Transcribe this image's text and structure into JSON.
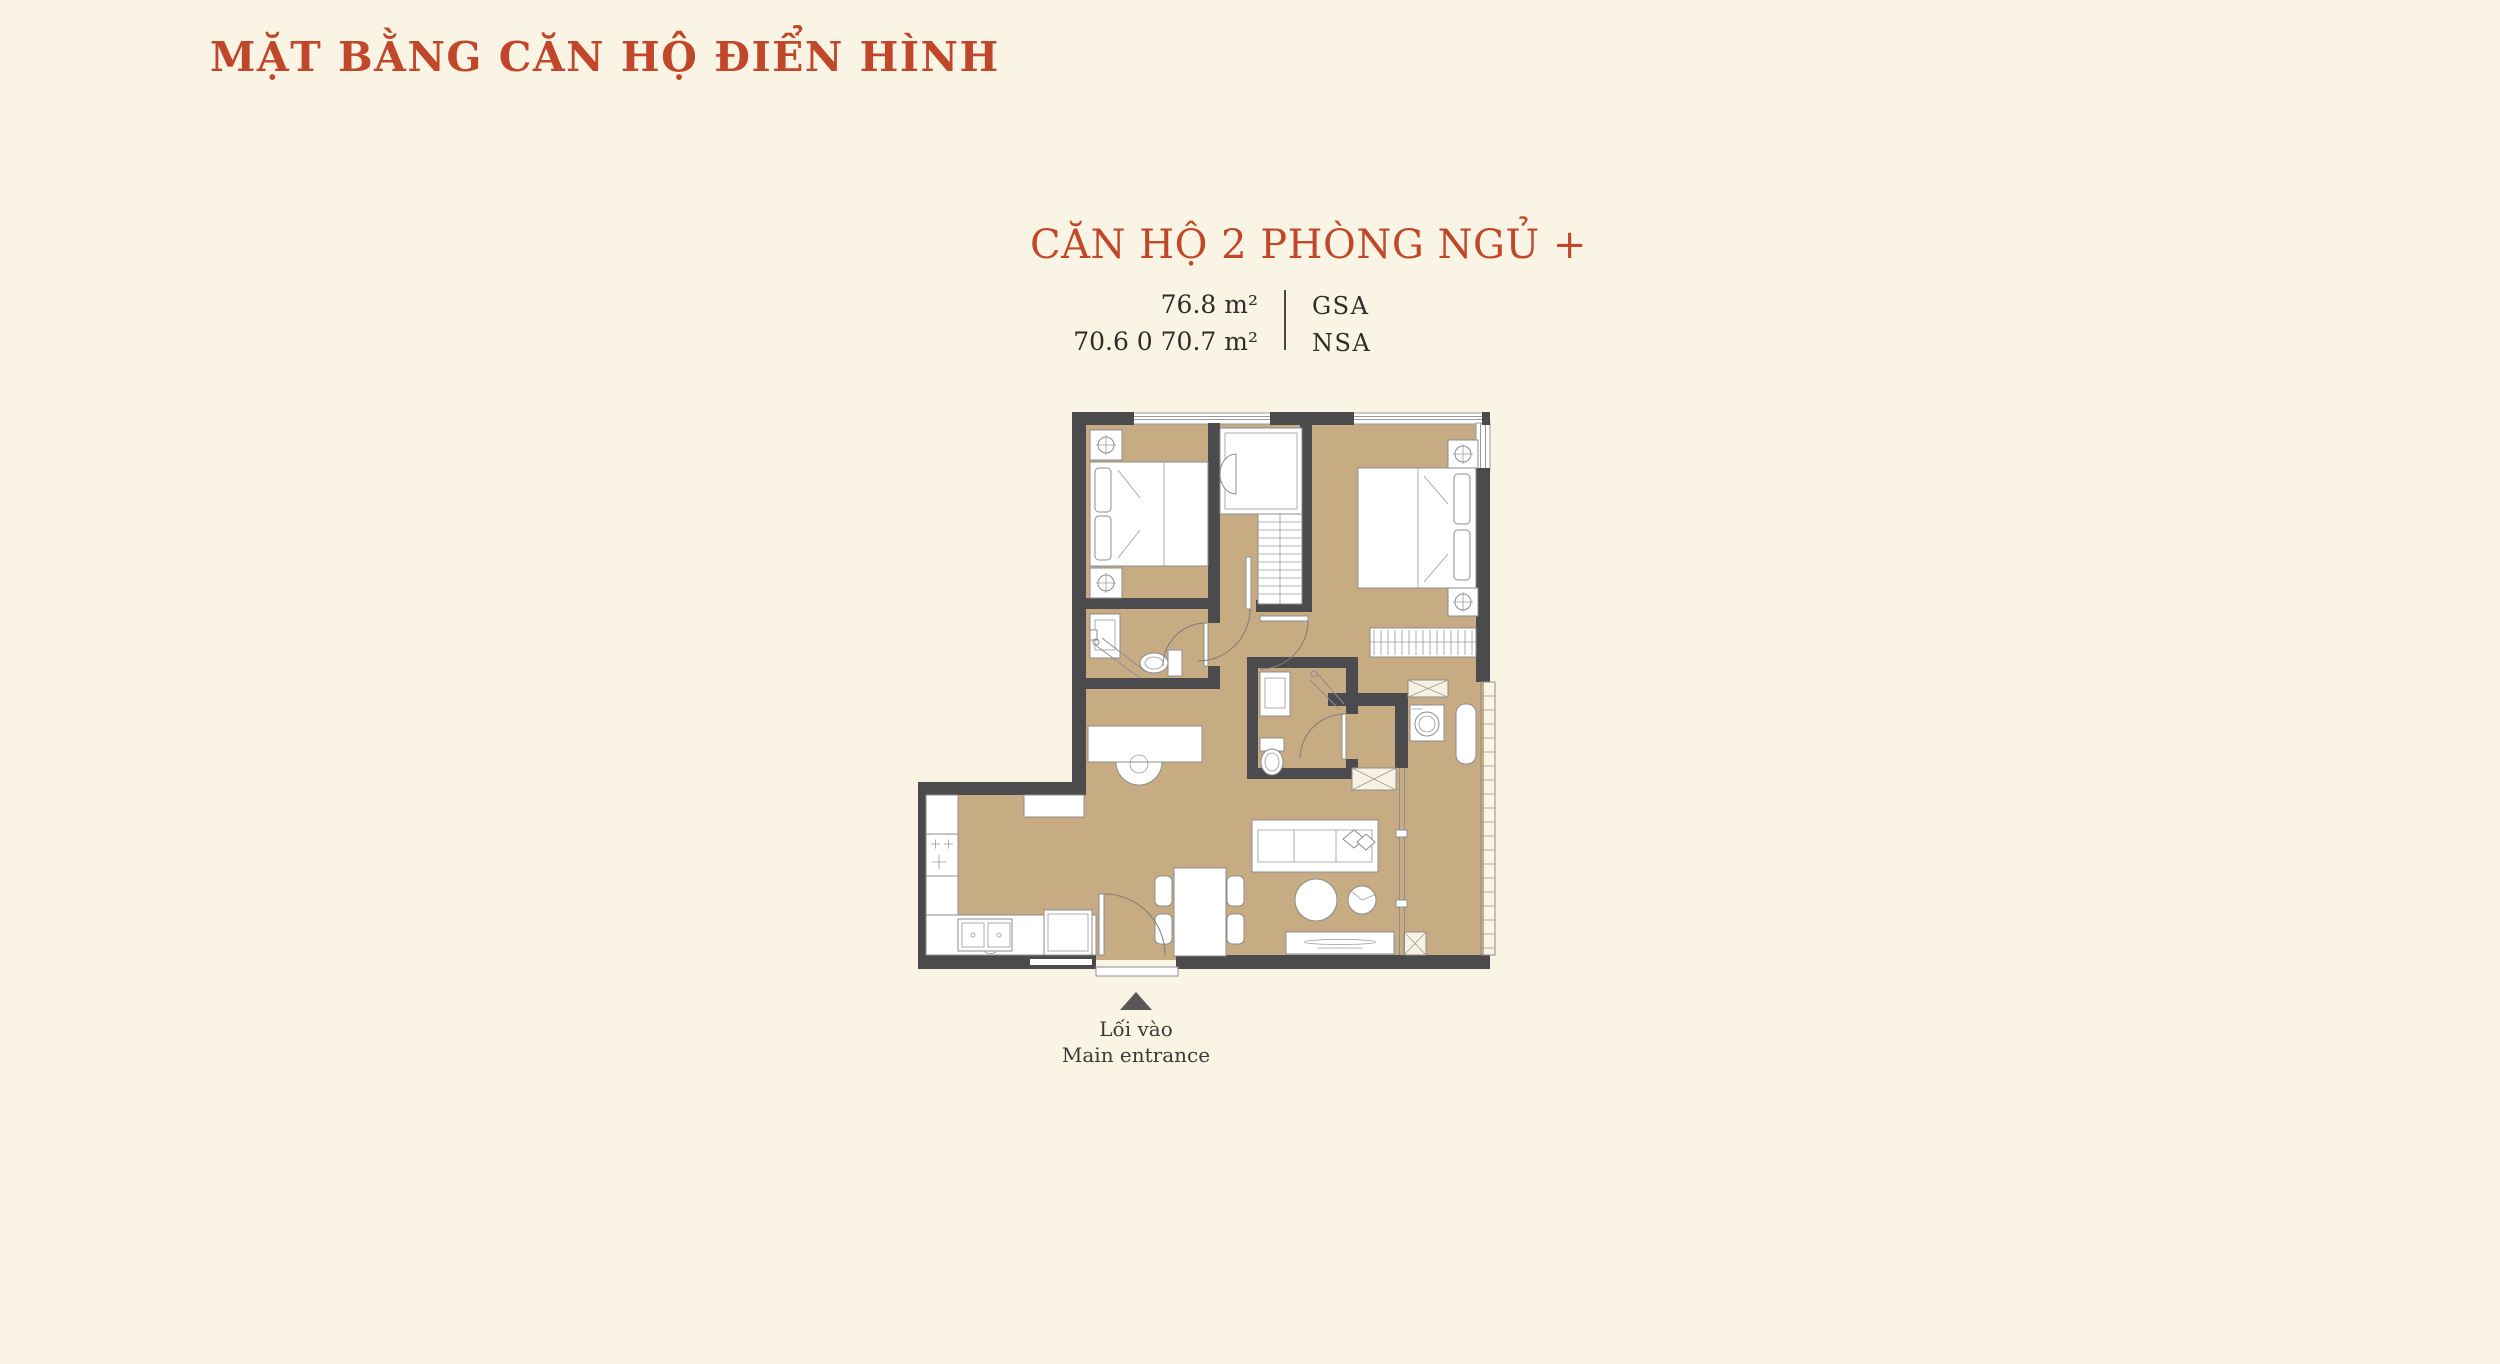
{
  "page": {
    "background": "#FAF4E4"
  },
  "header": {
    "title": "MẶT BẰNG CĂN HỘ ĐIỂN HÌNH"
  },
  "unit": {
    "name": "CĂN HỘ 2 PHÒNG NGỦ +",
    "areas": [
      {
        "value": "76.8 m²",
        "label": "GSA"
      },
      {
        "value": "70.6 0 70.7 m²",
        "label": "NSA"
      }
    ]
  },
  "entrance": {
    "marker": "up-triangle",
    "label_vi": "Lối vào",
    "label_en": "Main entrance"
  },
  "colors": {
    "accent_red": "#C1472A",
    "wall_gray": "#4B4B4D",
    "floor_tan": "#C7AB83",
    "text_dark": "#2E2D2B",
    "marker_gray": "#58585A",
    "background_cream": "#FAF4E4"
  },
  "floor_plan_icons": [
    "double-bed-icon",
    "double-bed-icon",
    "nightstand-lamp-icon",
    "wardrobe-icon",
    "closet-shelves-icon",
    "sink-icon",
    "toilet-icon",
    "shower-icon",
    "vanity-basin-icon",
    "stove-icon",
    "kitchen-sink-icon",
    "fridge-icon",
    "dining-table-icon",
    "chair-icon",
    "sofa-icon",
    "coffee-table-icon",
    "armchair-icon",
    "tv-console-icon",
    "washing-machine-icon",
    "balcony-bench-icon",
    "balcony-railing-icon",
    "door-swing-icon",
    "shaft-icon",
    "window-icon"
  ]
}
